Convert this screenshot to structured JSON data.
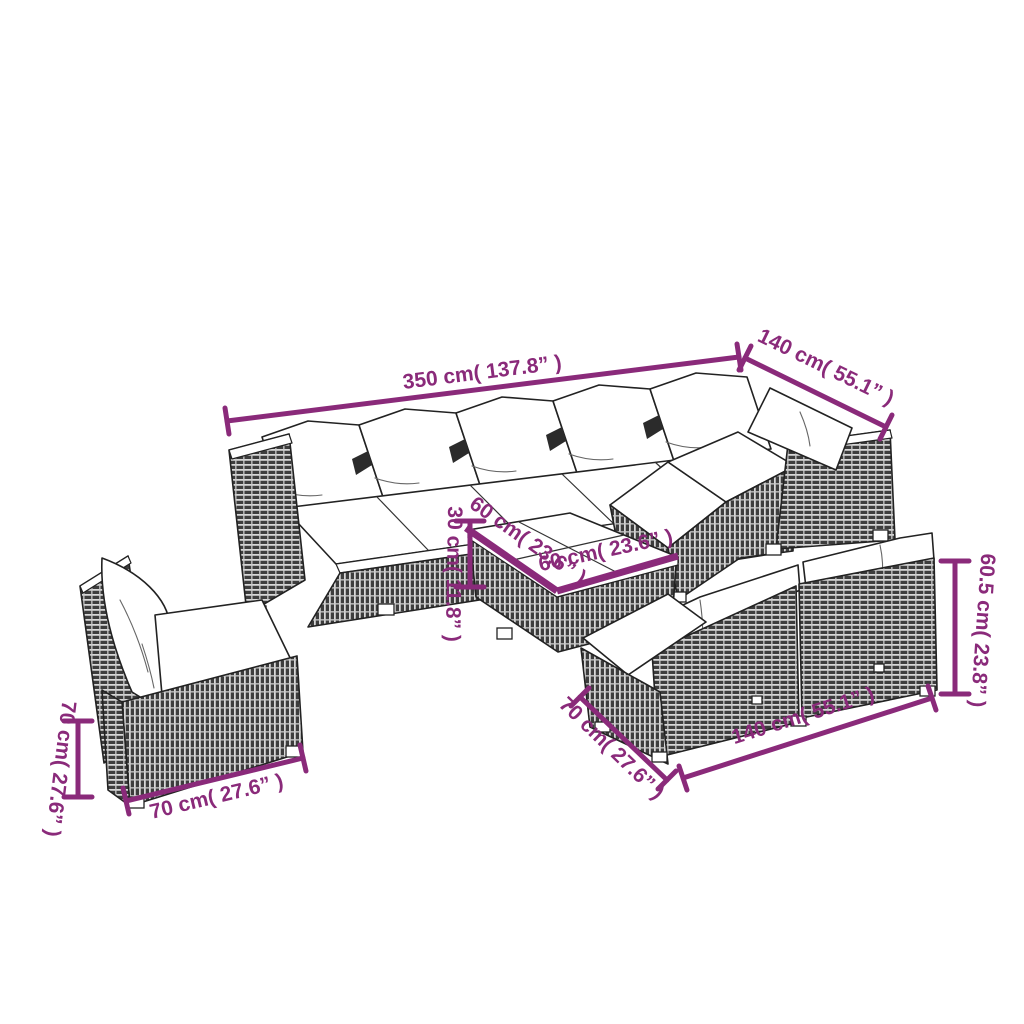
{
  "diagram": {
    "colors": {
      "accent": "#8a2a7a",
      "outline": "#222222",
      "rattan_dark": "#3d3d3d",
      "cushion": "#ffffff",
      "background": "#ffffff"
    },
    "labels": {
      "sectional_width": "350 cm( 137.8” )",
      "sectional_depth": "140 cm( 55.1” )",
      "table_height": "30 cm( 11.8” )",
      "table_side_a": "60 cm( 23.6” )",
      "table_side_b": "60 cm( 23.6” )",
      "chair_height": "70 cm( 27.6” )",
      "chair_width": "70 cm( 27.6” )",
      "sofa_depth": "70 cm( 27.6” )",
      "sofa_width": "140 cm( 55.1” )",
      "sofa_height": "60.5 cm( 23.8” )"
    }
  }
}
